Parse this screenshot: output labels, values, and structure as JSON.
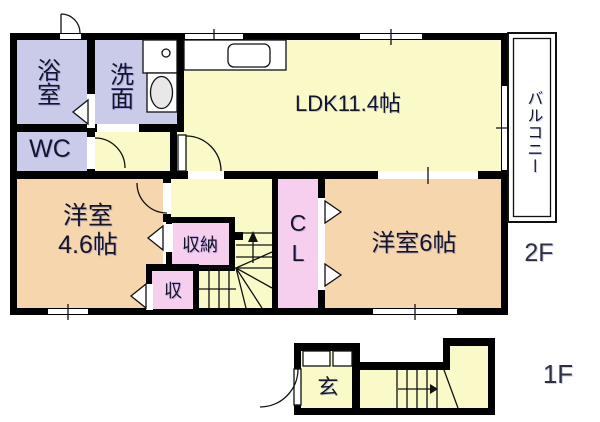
{
  "colors": {
    "wall": "#000000",
    "line": "#111111",
    "room_yellow": "#fafac9",
    "room_lavender": "#c9cbe9",
    "room_peach": "#f6d6ad",
    "room_pink": "#f7cfee",
    "fixture_gray": "#e8e8e8",
    "label_text": "#15152a",
    "floor_label_text": "#2f2f3f"
  },
  "floor2": {
    "label": "2F",
    "rooms": {
      "bath": "浴室",
      "washroom": "洗面",
      "wc": "WC",
      "ldk": "LDK11.4帖",
      "western_room_small_line1": "洋室",
      "western_room_small_line2": "4.6帖",
      "storage": "収納",
      "storage_small": "収",
      "closet": "CL",
      "western_room_large": "洋室6帖",
      "balcony": "バルコニー"
    }
  },
  "floor1": {
    "label": "1F",
    "rooms": {
      "entrance": "玄"
    }
  }
}
